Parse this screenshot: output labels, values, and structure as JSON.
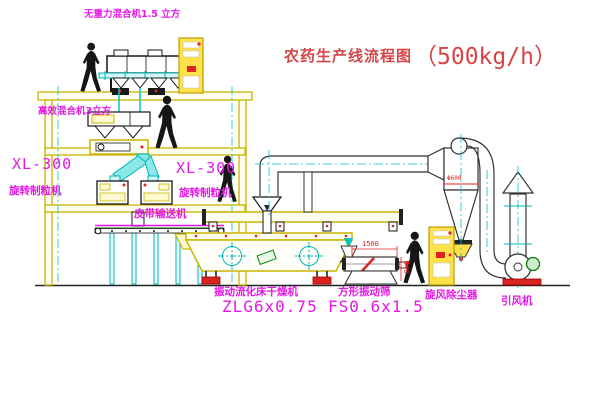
{
  "title": {
    "name": "农药生产线流程图",
    "capacity": "（500kg/h）"
  },
  "labels": {
    "gravity_mixer": "无重力混合机1.5 立方",
    "high_mixer": "高效混合机3立方",
    "granulator_left_model": "XL-300",
    "granulator_left_name": "旋转制粒机",
    "granulator_right_model": "XL-300",
    "granulator_right_name": "旋转制粒机",
    "belt_conveyor": "皮带输送机",
    "dryer_name": "振动流化床干燥机",
    "dryer_model": "ZLG6x0.75",
    "screen_name": "方形振动筛",
    "screen_model": "FS0.6x1.5",
    "cyclone": "旋风除尘器",
    "fan": "引风机"
  },
  "dimensions": {
    "screen_length": "1500",
    "screen_height": "540",
    "cyclone_dia": "Φ600"
  },
  "colors": {
    "line_yellow": "#c9b400",
    "line_cyan": "#00c5c5",
    "line_black": "#1a1a1a",
    "label_magenta": "#e616e6",
    "title_red": "#d64545",
    "accent_red": "#e02222",
    "accent_green": "#0a8a0a",
    "cabinet_yellow": "#ffe24a"
  }
}
